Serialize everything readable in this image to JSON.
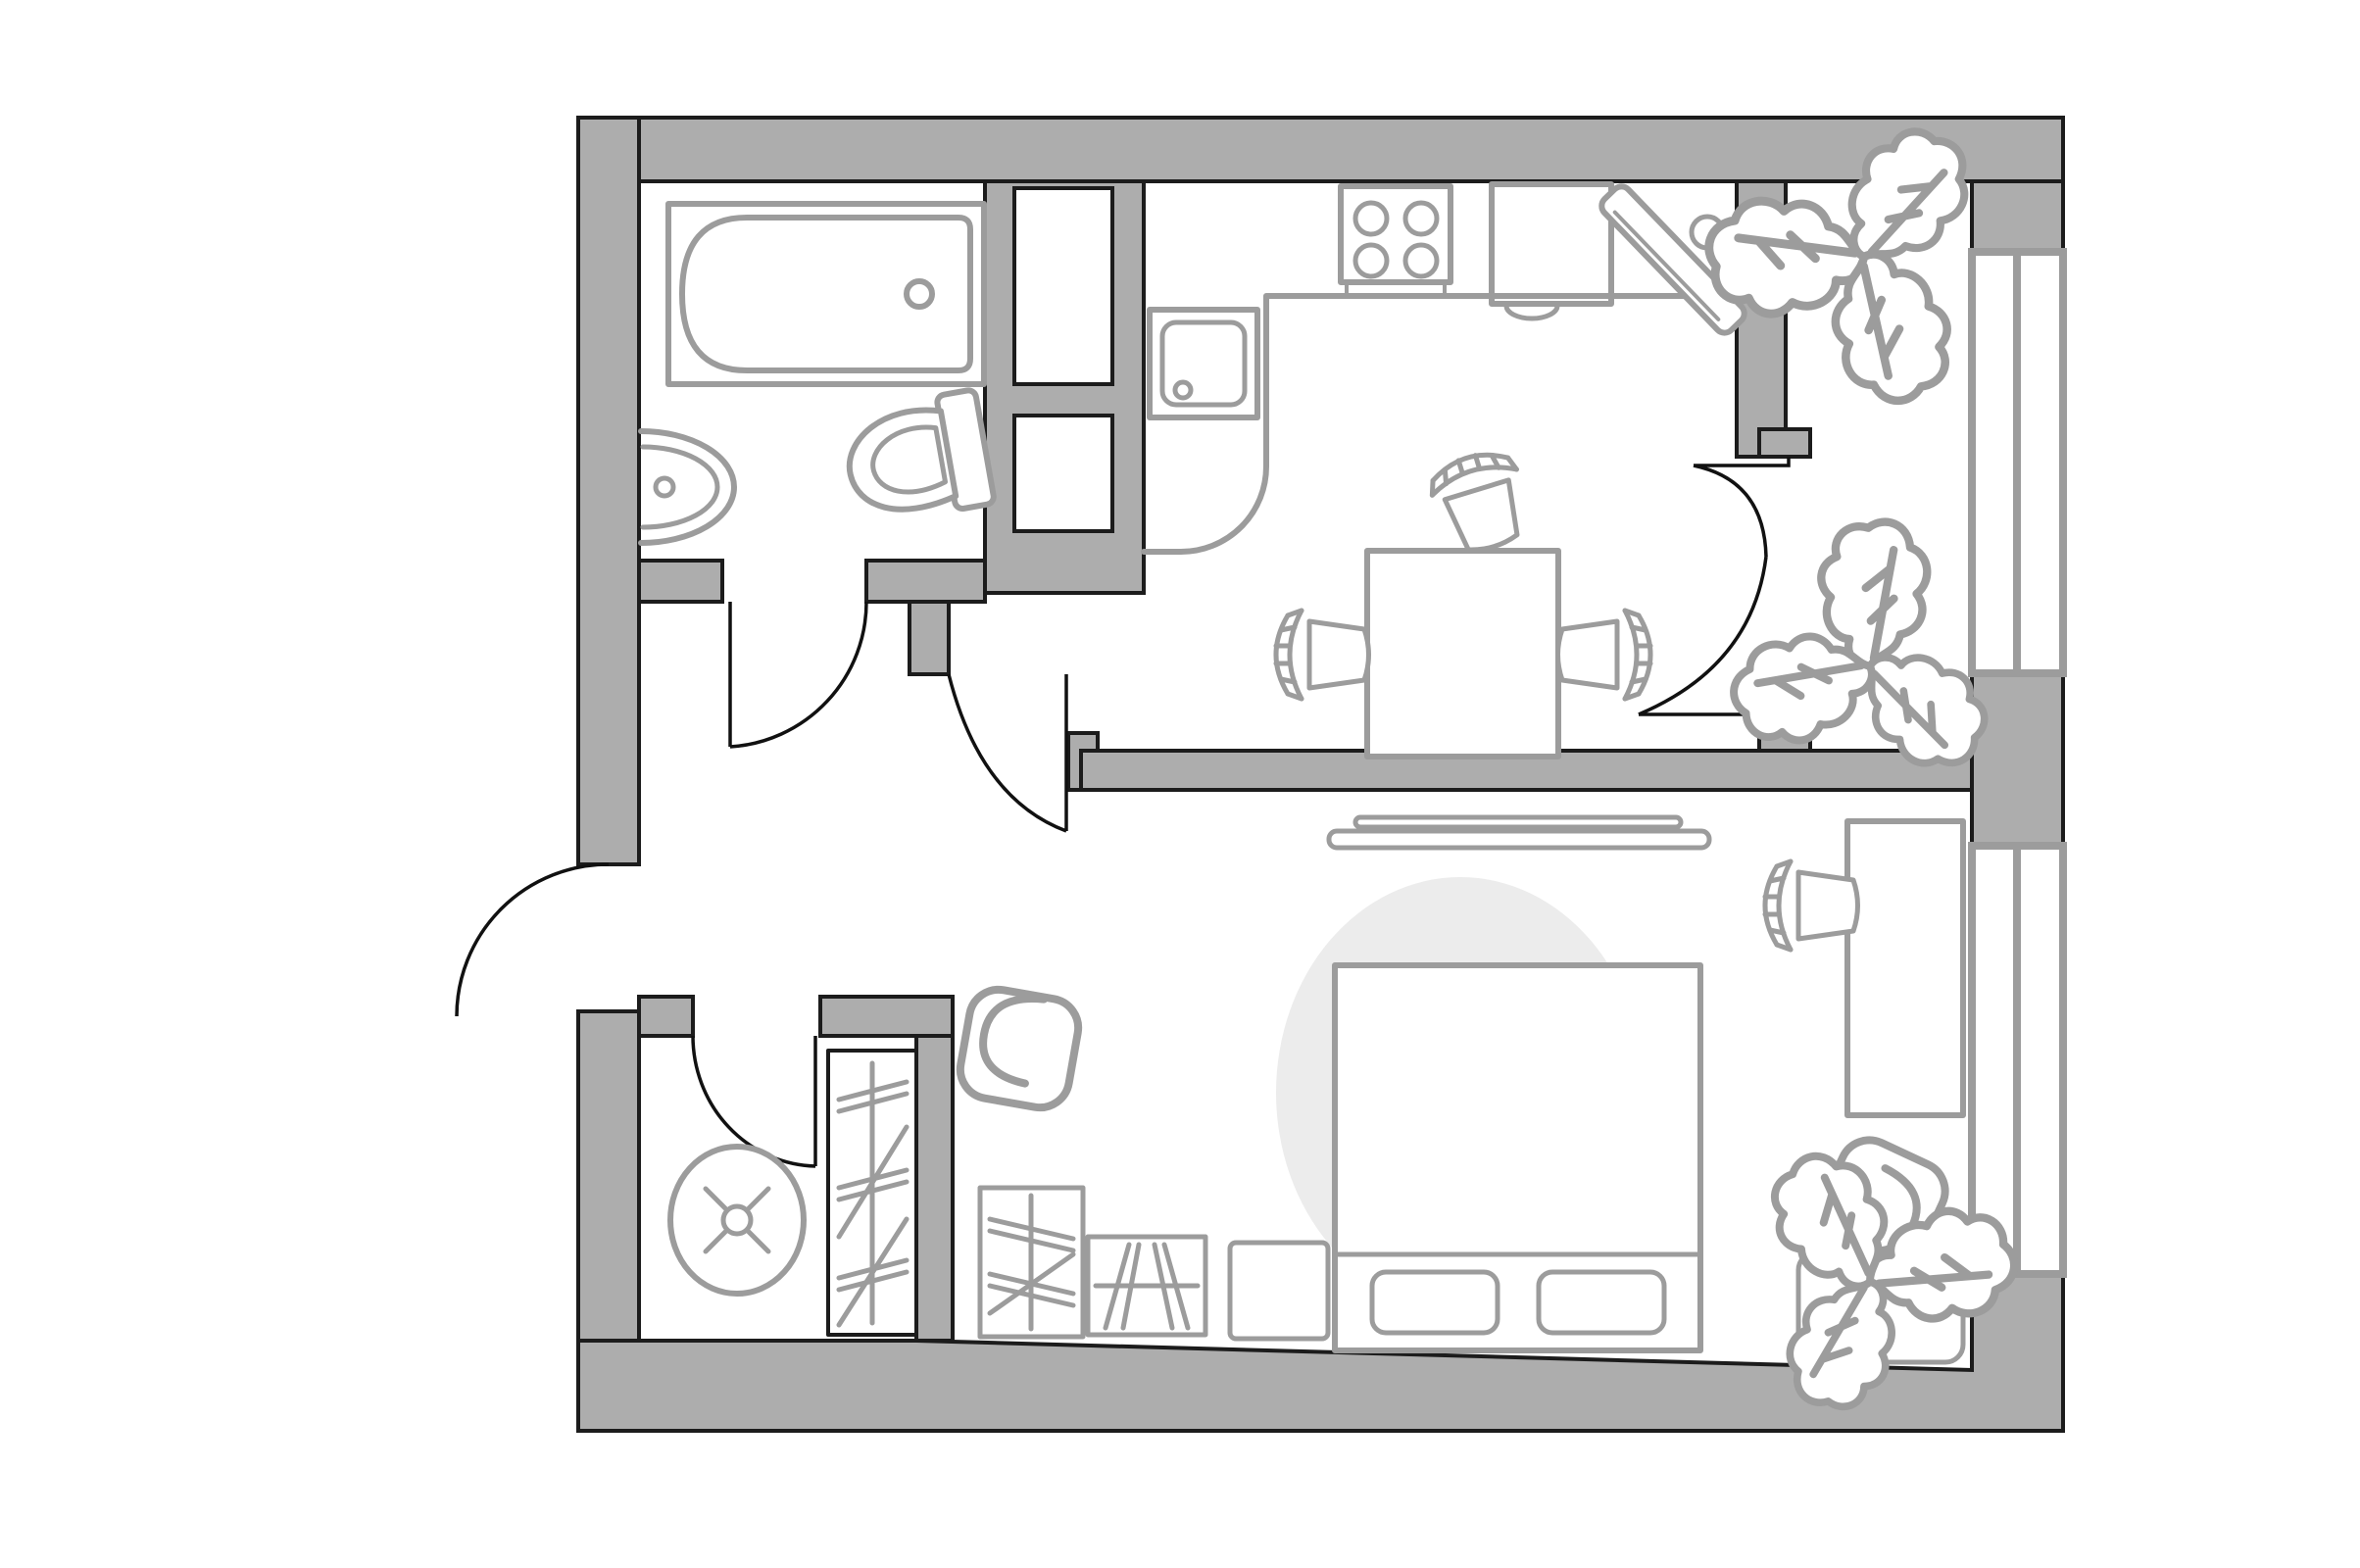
{
  "image": {
    "kind": "floor-plan",
    "description": "Top-down architectural floor plan of a one-bedroom apartment with balcony, no text labels visible"
  },
  "colors": {
    "page_bg": "#ffffff",
    "floor_fill": "#ffffff",
    "wall_fill": "#adadad",
    "wall_outline": "#1c1c1c",
    "door_stroke": "#111111",
    "window_frame": "#9c9c9c",
    "fixture_stroke": "#9c9c9c",
    "rug_fill": "#ececec",
    "niche_fill": "#ffffff"
  },
  "rooms": [
    {
      "name": "bathroom",
      "fixtures": [
        "bathtub",
        "washbasin",
        "toilet"
      ]
    },
    {
      "name": "hallway",
      "fixtures": [
        "entry-door-swing",
        "bathroom-door-swing",
        "storage-door-swing",
        "room-door-swing"
      ]
    },
    {
      "name": "storage-room",
      "fixtures": [
        "round-appliance",
        "built-in-wardrobe"
      ]
    },
    {
      "name": "kitchen-dining",
      "fixtures": [
        "kitchen-counter",
        "kitchen-sink",
        "stove-4-burners",
        "refrigerator",
        "wall-mounted-swivel-board",
        "dining-table",
        "dining-chairs-x3",
        "balcony-door-swing"
      ]
    },
    {
      "name": "living-sleeping-room",
      "fixtures": [
        "tv-console",
        "round-rug",
        "double-bed",
        "pillows-x2",
        "nightstand",
        "hatched-dresser",
        "hatched-wardrobe",
        "armchair-left",
        "armchair-right",
        "desk",
        "desk-chair",
        "corner-planter"
      ]
    },
    {
      "name": "balcony",
      "fixtures": [
        "glazing-window-upper",
        "glazing-window-lower",
        "plant-top",
        "plant-middle",
        "plant-bottom"
      ]
    }
  ]
}
